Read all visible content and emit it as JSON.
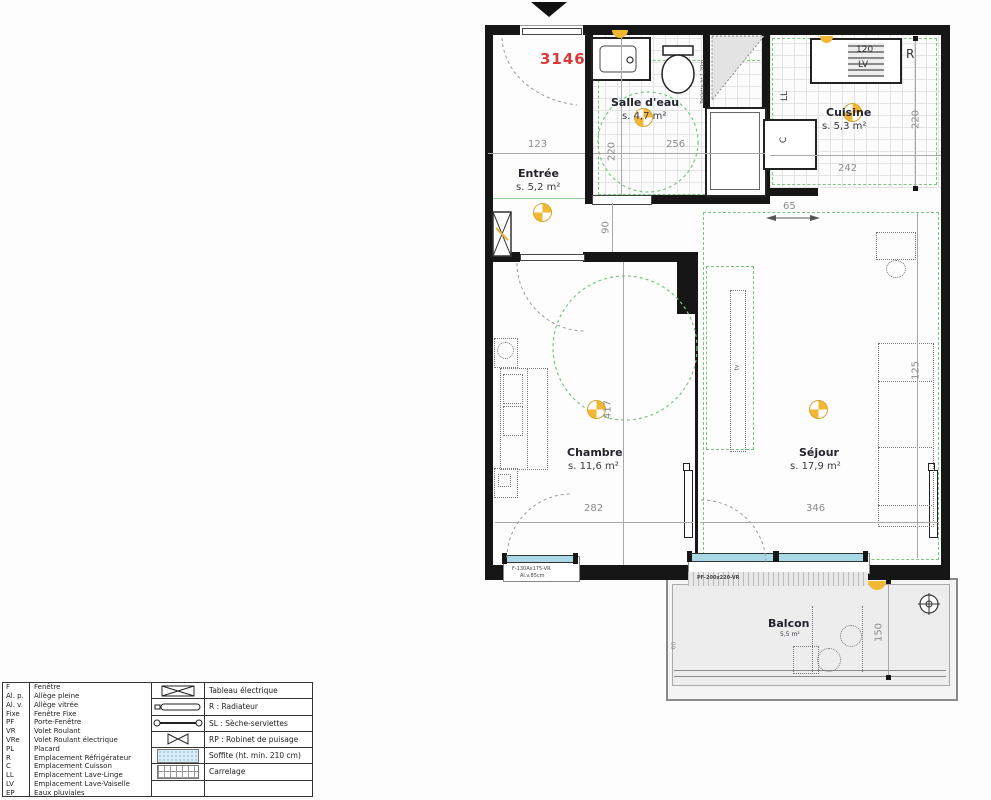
{
  "lot": {
    "number": "3146"
  },
  "rooms": {
    "entree": {
      "name": "Entrée",
      "area": "s. 5,2 m²"
    },
    "salle_deau": {
      "name": "Salle d'eau",
      "area": "s. 4,7 m²"
    },
    "cuisine": {
      "name": "Cuisine",
      "area": "s. 5,3 m²"
    },
    "chambre": {
      "name": "Chambre",
      "area": "s. 11,6 m²"
    },
    "sejour": {
      "name": "Séjour",
      "area": "s. 17,9 m²"
    },
    "balcon": {
      "name": "Balcon",
      "area": "5,5 m²"
    }
  },
  "dims": {
    "entree_width": "123",
    "salle_deau_depth": "220",
    "salle_deau_width": "256",
    "cuisine_width": "242",
    "cuisine_depth": "220",
    "passage_width": "90",
    "kitchen_offset": "65",
    "chambre_length": "417",
    "chambre_width": "282",
    "sejour_width": "346",
    "sejour_depth": "125",
    "balcon_depth": "150",
    "balcon_side": "60"
  },
  "annotations": {
    "fridge": "R",
    "washing_machine": "LL",
    "dishwasher_width": "120",
    "dishwasher": "LV",
    "cooktop": "C",
    "tv": "tv",
    "shelf": "Tablette ht.1,20m",
    "chambre_window": "F-130Ax175-VR",
    "chambre_window_sill": "Al.v.85cm",
    "sejour_window": "PF-200x220-VR"
  },
  "legend": {
    "abbreviations": [
      {
        "abbr": "F",
        "label": "Fenêtre"
      },
      {
        "abbr": "Al. p.",
        "label": "Allège pleine"
      },
      {
        "abbr": "Al. v.",
        "label": "Allège vitrée"
      },
      {
        "abbr": "Fixe",
        "label": "Fenêtre Fixe"
      },
      {
        "abbr": "PF",
        "label": "Porte-Fenêtre"
      },
      {
        "abbr": "VR",
        "label": "Volet Roulant"
      },
      {
        "abbr": "VRe",
        "label": "Volet Roulant électrique"
      },
      {
        "abbr": "PL",
        "label": "Placard"
      },
      {
        "abbr": "R",
        "label": "Emplacement Réfrigérateur"
      },
      {
        "abbr": "C",
        "label": "Emplacement Cuisson"
      },
      {
        "abbr": "LL",
        "label": "Emplacement Lave-Linge"
      },
      {
        "abbr": "LV",
        "label": "Emplacement Lave-Vaiselle"
      },
      {
        "abbr": "EP",
        "label": "Eaux pluviales"
      }
    ],
    "symbols": [
      {
        "icon": "electrical-panel",
        "label": "Tableau électrique"
      },
      {
        "icon": "radiator",
        "label": "R : Radiateur"
      },
      {
        "icon": "towel-dryer",
        "label": "SL : Sèche-serviettes"
      },
      {
        "icon": "tap-valve",
        "label": "RP : Robinet de puisage"
      },
      {
        "icon": "soffit-hatch",
        "label": "Soffite (ht. min. 210 cm)"
      },
      {
        "icon": "tile-grid",
        "label": "Carrelage"
      }
    ]
  },
  "colors": {
    "wall": "#161616",
    "lot_red": "#d63b3b",
    "light_yellow": "#f2b735",
    "accessibility_green": "#7cc47f",
    "glazing_blue": "#a9d9e6",
    "dimension_grey": "#8d8d8d"
  }
}
